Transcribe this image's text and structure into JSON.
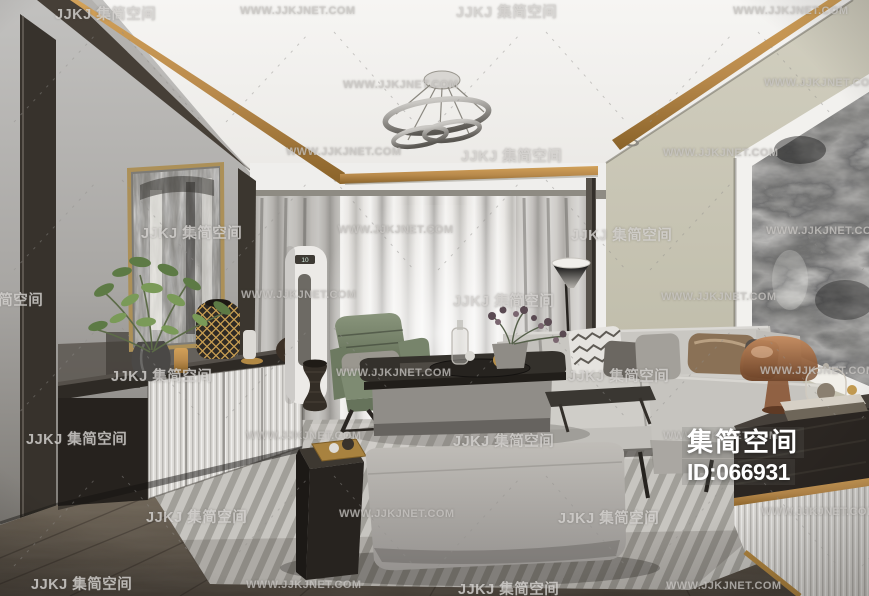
{
  "brand": {
    "name": "集简空间",
    "id_label": "ID:066931"
  },
  "ac_unit": {
    "display": "10"
  },
  "watermark": {
    "logo_text": "JJKJ 集简空间",
    "url_text": "WWW.JJKJNET.COM",
    "color": "#bdbbb8",
    "items": [
      {
        "x": 55,
        "y": 3,
        "t": "logo"
      },
      {
        "x": 240,
        "y": 5,
        "t": "url"
      },
      {
        "x": 456,
        "y": 1,
        "t": "logo"
      },
      {
        "x": 733,
        "y": 5,
        "t": "url"
      },
      {
        "x": 343,
        "y": 79,
        "t": "url"
      },
      {
        "x": 764,
        "y": 77,
        "t": "url"
      },
      {
        "x": 286,
        "y": 146,
        "t": "url"
      },
      {
        "x": 461,
        "y": 145,
        "t": "logo"
      },
      {
        "x": 663,
        "y": 147,
        "t": "url"
      },
      {
        "x": 141,
        "y": 222,
        "t": "logo"
      },
      {
        "x": 338,
        "y": 224,
        "t": "url"
      },
      {
        "x": 571,
        "y": 224,
        "t": "logo"
      },
      {
        "x": 766,
        "y": 225,
        "t": "url"
      },
      {
        "x": -58,
        "y": 289,
        "t": "logo"
      },
      {
        "x": 241,
        "y": 289,
        "t": "url"
      },
      {
        "x": 453,
        "y": 290,
        "t": "logo"
      },
      {
        "x": 661,
        "y": 291,
        "t": "url"
      },
      {
        "x": 111,
        "y": 365,
        "t": "logo"
      },
      {
        "x": 336,
        "y": 367,
        "t": "url"
      },
      {
        "x": 568,
        "y": 365,
        "t": "logo"
      },
      {
        "x": 760,
        "y": 365,
        "t": "url"
      },
      {
        "x": 26,
        "y": 428,
        "t": "logo"
      },
      {
        "x": 246,
        "y": 430,
        "t": "url"
      },
      {
        "x": 453,
        "y": 430,
        "t": "logo"
      },
      {
        "x": 663,
        "y": 430,
        "t": "url"
      },
      {
        "x": 146,
        "y": 506,
        "t": "logo"
      },
      {
        "x": 339,
        "y": 508,
        "t": "url"
      },
      {
        "x": 558,
        "y": 507,
        "t": "logo"
      },
      {
        "x": 761,
        "y": 506,
        "t": "url"
      },
      {
        "x": 31,
        "y": 573,
        "t": "logo"
      },
      {
        "x": 246,
        "y": 579,
        "t": "url"
      },
      {
        "x": 458,
        "y": 578,
        "t": "logo"
      },
      {
        "x": 666,
        "y": 580,
        "t": "url"
      }
    ]
  },
  "palette": {
    "accent_gold": "#b98a4c",
    "wall_right_beige": "#c6c3b1",
    "wall_left_gray": "#a8a6a3",
    "curtain": "#e8e6e3",
    "sofa_gray": "#cbc9c4",
    "armchair_green": "#77846b",
    "floor_wood": "#5f574d",
    "rug": "#c7c5c0",
    "dark_wood": "#2b2622"
  }
}
